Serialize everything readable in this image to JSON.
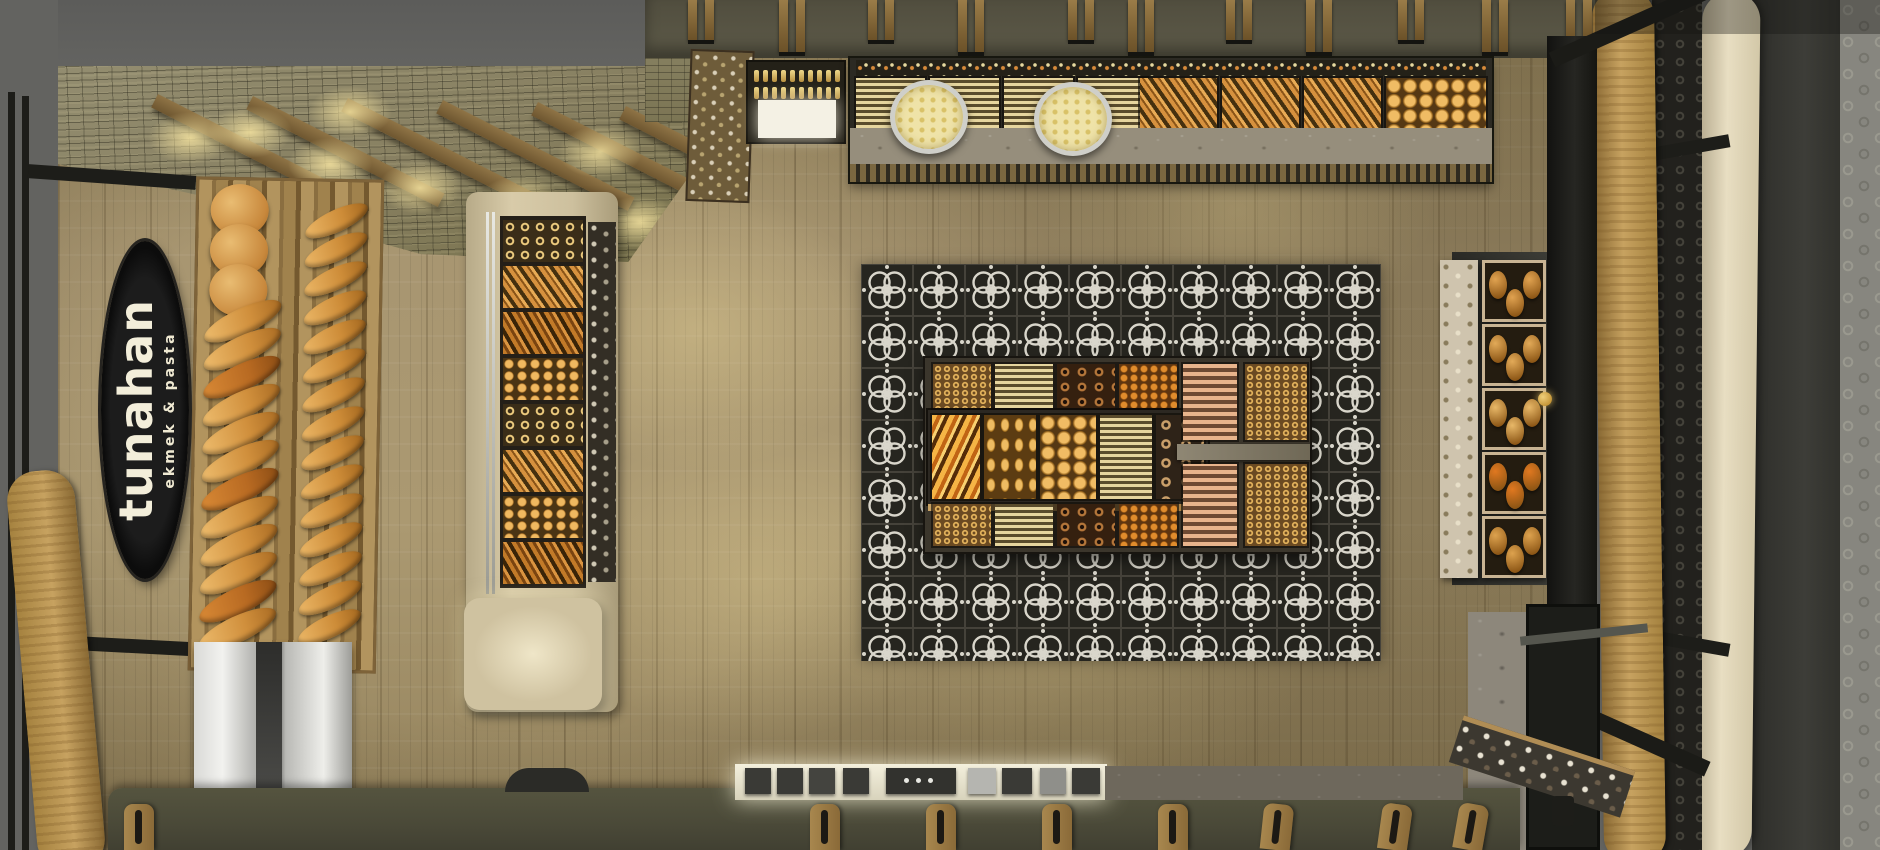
{
  "scene": {
    "type": "top-down 3d interior render",
    "title": "Bakery shop interior, bird's-eye view",
    "sign": {
      "brand": "tunahan",
      "tagline": "ekmek & pasta"
    }
  },
  "palette": {
    "floor_wood": "#a89671",
    "ceiling_mosaic": "#8d8768",
    "ceiling_void": "#5c5c5a",
    "frame_black": "#1d1d19",
    "sign_black": "#1c1c1c",
    "sign_text": "#f3eeda",
    "rack_wood": "#b2945e",
    "bread_gold": "#dd9f4f",
    "bread_orange": "#c97a2e",
    "case_cream": "#d8cba9",
    "carpet_dark": "#26251f",
    "carpet_pattern": "#d9d6cb",
    "island_base": "#3b362c",
    "marble": "#968e7c",
    "steel": "#d9d9d6",
    "wall_gray": "#87867f",
    "cream_arc": "#e8dec2",
    "counter_green": "#4a4938"
  },
  "left_rack": {
    "label": "wall bread rack",
    "items": [
      "round loaves",
      "baguettes"
    ],
    "round_loaves": 3,
    "baguettes_col1": 12,
    "baguettes_col2": 15
  },
  "display_case": {
    "label": "upright pastry case",
    "sections": [
      "simit rings",
      "croissants",
      "glazed croissants",
      "buns",
      "simit rings",
      "croissants",
      "buns",
      "glazed croissants"
    ]
  },
  "top_counter": {
    "label": "service display counter",
    "features": [
      "corner goods shelf",
      "bottle cooler",
      "packaged sweets",
      "round platters",
      "bread trays"
    ],
    "bottle_rows": 2,
    "bottles_per_row": 10,
    "domes": 2
  },
  "carpet": {
    "label": "patterned tile carpet",
    "pattern": "quatrefoil rosette",
    "tiles_x": 10,
    "tiles_y": 8
  },
  "island": {
    "label": "central pastry island",
    "outer_trays": [
      "mini simit",
      "butter cookies",
      "chocolate rings",
      "amber cookies"
    ],
    "right_trays": [
      "peach cookies",
      "gold rings"
    ],
    "center_trays": [
      "croissants",
      "sesame rolls",
      "round buns",
      "cream cookies",
      "chocolate ring grid"
    ]
  },
  "right_rack": {
    "label": "bread cubby rack",
    "cubbies": [
      "rolls",
      "round buns",
      "baguette halves",
      "glazed orange pastries",
      "rolls"
    ]
  },
  "back_counter": {
    "label": "barista back counter",
    "equipment": "espresso machines and grinders"
  },
  "architecture": {
    "hanging_slats": 11,
    "stool_backs": 8,
    "ceiling": "mosaic tile with wood beams",
    "floor": "oak planks"
  }
}
